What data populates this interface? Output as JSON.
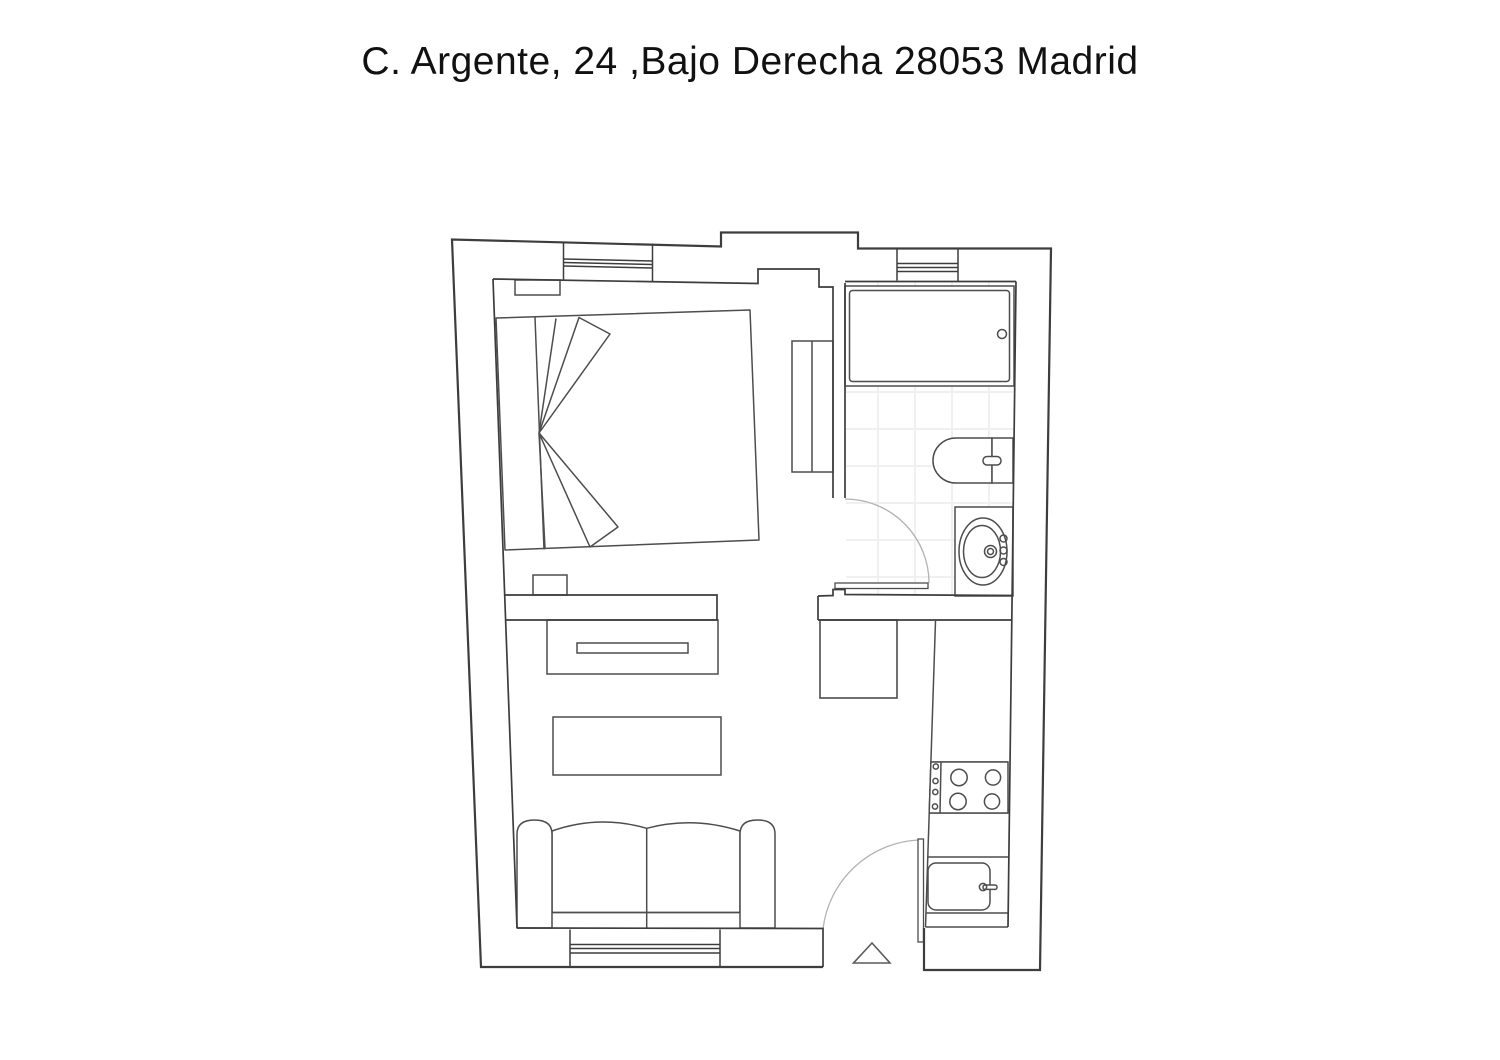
{
  "title": "C. Argente, 24 ,Bajo Derecha 28053 Madrid",
  "plan": {
    "colors": {
      "background": "#ffffff",
      "wall_line": "#3d3d3d",
      "furniture_line": "#4d4d4d",
      "door_arc_line": "#b3b3b3",
      "tile_line": "#f0f0f0",
      "title_text": "#111111"
    },
    "symbols": [
      "double-bed",
      "folded-duvet-fan",
      "wardrobe",
      "radiator",
      "bathtub",
      "toilet",
      "washbasin-vanity",
      "door-swing-arc",
      "sofa",
      "coffee-table",
      "tv-cabinet",
      "fridge",
      "stove-4-burners",
      "kitchen-sink",
      "entrance-triangle-marker",
      "window-triple-line"
    ],
    "rooms_count": 4,
    "windows_count": 3,
    "doors_count": 3
  }
}
